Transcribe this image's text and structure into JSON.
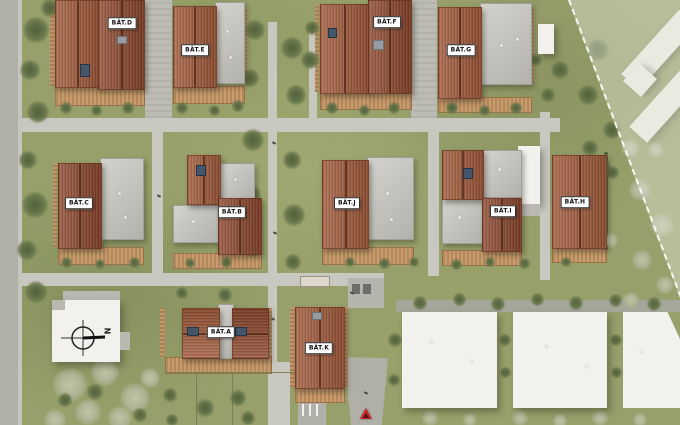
{
  "buildings": [
    {
      "id": "bat-d",
      "label": "BÂT.D"
    },
    {
      "id": "bat-e",
      "label": "BÂT.E"
    },
    {
      "id": "bat-f",
      "label": "BÂT.F"
    },
    {
      "id": "bat-g",
      "label": "BÂT.G"
    },
    {
      "id": "bat-c",
      "label": "BÂT.C"
    },
    {
      "id": "bat-b",
      "label": "BÂT.B"
    },
    {
      "id": "bat-j",
      "label": "BÂT.J"
    },
    {
      "id": "bat-i",
      "label": "BÂT.I"
    },
    {
      "id": "bat-h",
      "label": "BÂT.H"
    },
    {
      "id": "bat-a",
      "label": "BÂT.A"
    },
    {
      "id": "bat-k",
      "label": "BÂT.K"
    }
  ],
  "compass": {
    "label": "N"
  },
  "colors": {
    "terracotta_roof": "#a25c3d",
    "terracotta_roof_dark": "#8f4a30",
    "flat_roof_gray": "#c2c1bb",
    "grass": "#97a06a",
    "road": "#b0afa8",
    "path": "#c9c8c0",
    "wood_deck": "#c49a6c",
    "neighbor_building_white": "#f2f1ed",
    "tree_dark": "#5c6b40",
    "tree_light": "#b7bd9e",
    "entrance_marker_red": "#c3262a",
    "boundary_line": "#ffffff"
  }
}
